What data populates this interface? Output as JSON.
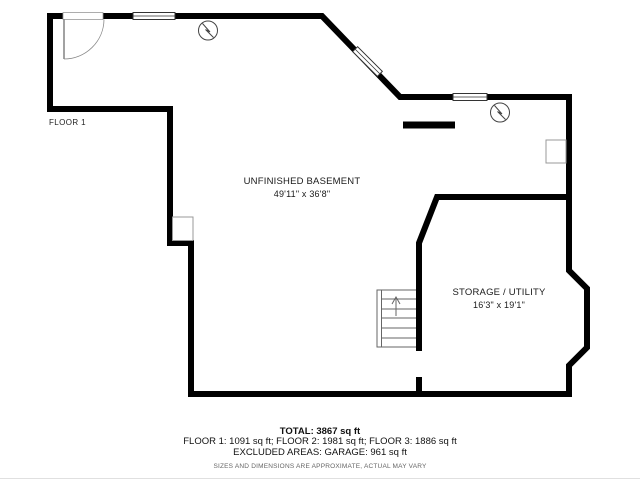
{
  "plan": {
    "level_label": "FLOOR 1",
    "rooms": [
      {
        "name": "UNFINISHED BASEMENT",
        "dimensions": "49'11\" x 36'8\""
      },
      {
        "name": "STORAGE / UTILITY",
        "dimensions": "16'3\" x 19'1\""
      }
    ],
    "icons": [
      {
        "name": "detector-icon",
        "shape": "circle-with-bolt"
      },
      {
        "name": "detector-icon",
        "shape": "circle-with-bolt"
      }
    ]
  },
  "summary": {
    "total": "TOTAL: 3867 sq ft",
    "floors": "FLOOR 1: 1091 sq ft; FLOOR 2: 1981 sq ft; FLOOR 3: 1886 sq ft",
    "excluded": "EXCLUDED AREAS: GARAGE: 961 sq ft",
    "disclaimer": "SIZES AND DIMENSIONS ARE APPROXIMATE, ACTUAL MAY VARY"
  },
  "colors": {
    "wall": "#000000",
    "thin_line": "#444444",
    "stair_line": "#666666",
    "muted_text": "#666666",
    "background": "#ffffff"
  }
}
